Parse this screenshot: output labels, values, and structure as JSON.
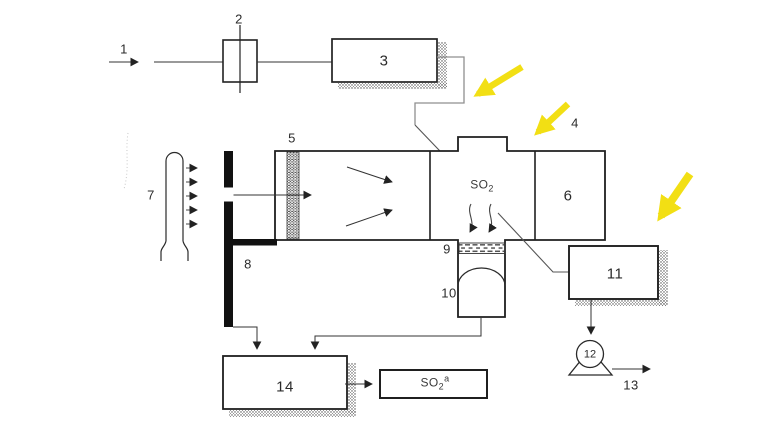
{
  "diagram": {
    "title_hint": "SO2 process flow schematic with highlight arrows",
    "colors": {
      "ink": "#222222",
      "pipe_gray": "#8f8f8f",
      "leader_gray": "#555555",
      "highlight_yellow": "#f2df14"
    },
    "components": {
      "c1": {
        "label": "1"
      },
      "c2": {
        "label": "2"
      },
      "c3": {
        "label": "3"
      },
      "c4": {
        "label": "4"
      },
      "c5": {
        "label": "5"
      },
      "c6": {
        "label": "6"
      },
      "c7": {
        "label": "7"
      },
      "c8": {
        "label": "8"
      },
      "c9": {
        "label": "9"
      },
      "c10": {
        "label": "10"
      },
      "c11": {
        "label": "11"
      },
      "c12": {
        "label": "12"
      },
      "c13": {
        "label": "13"
      },
      "c14": {
        "label": "14"
      }
    },
    "annotations": {
      "so2_gas": {
        "base": "SO",
        "sub": "2"
      },
      "so2_readout": {
        "base": "SO",
        "sub": "2",
        "sup": "a"
      }
    }
  }
}
